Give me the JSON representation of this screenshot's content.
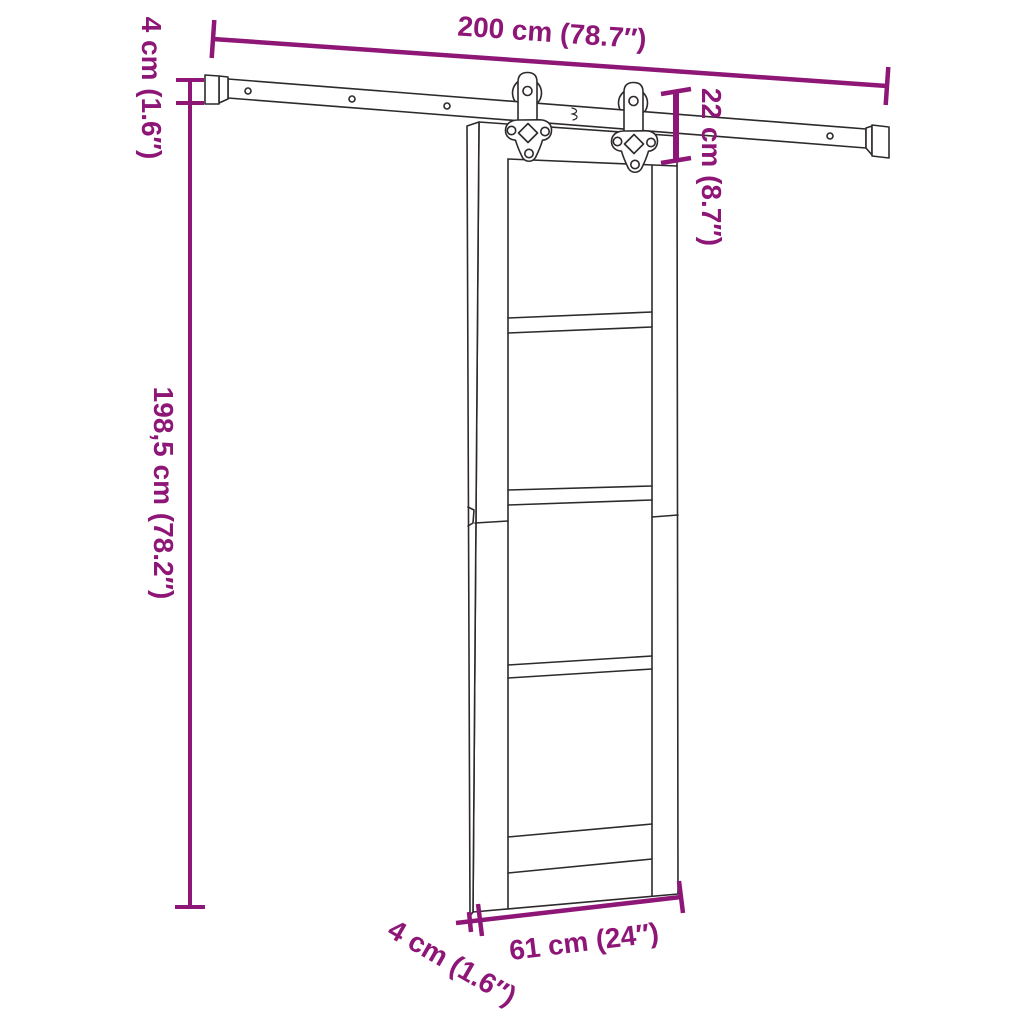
{
  "colors": {
    "dimension": "#8E1677",
    "line": "#2E2A2B",
    "background": "#FFFFFF"
  },
  "labels": {
    "rail_length": "200 cm (78.7″)",
    "rail_height": "4 cm (1.6″)",
    "drop_height": "22 cm (8.7″)",
    "door_height": "198,5 cm (78.2″)",
    "door_width": "61 cm (24″)",
    "door_thickness": "4 cm (1.6″)"
  }
}
